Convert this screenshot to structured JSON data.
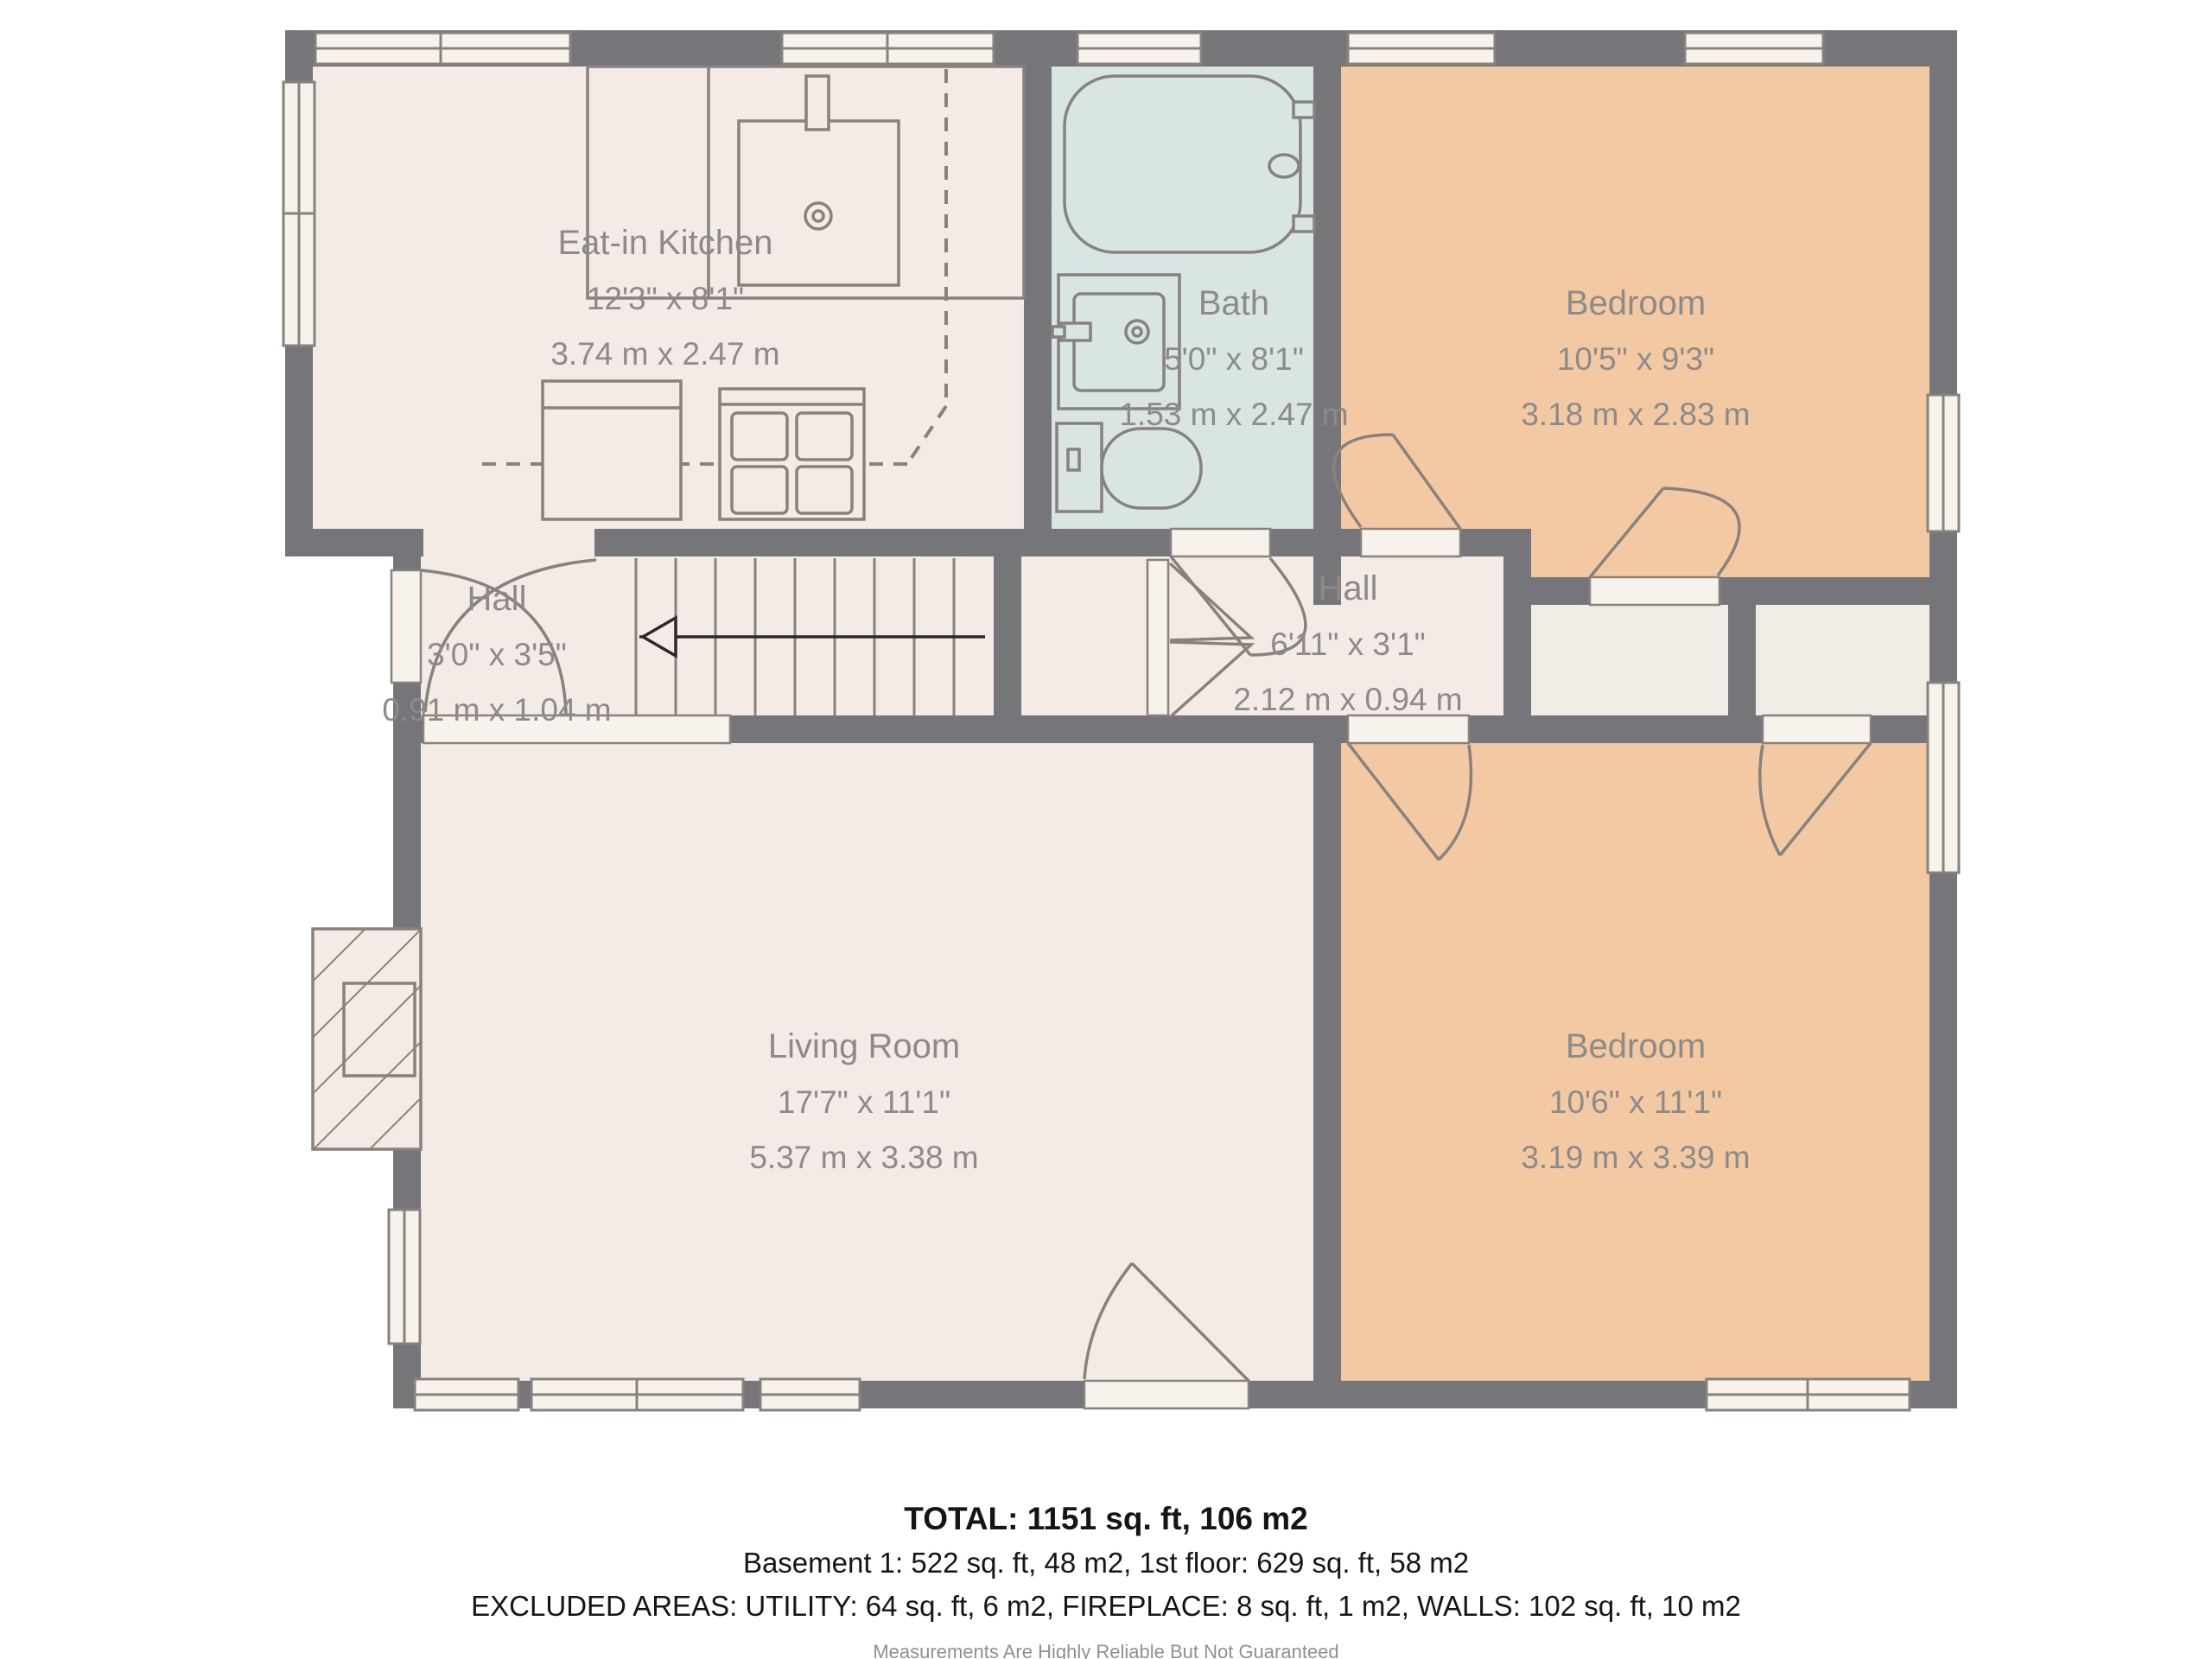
{
  "plan_title": "1st floor plan",
  "rooms": [
    {
      "id": "eat-in-kitchen",
      "name": "Eat-in Kitchen",
      "imperial": "12'3\" x 8'1\"",
      "metric": "3.74 m x 2.47 m"
    },
    {
      "id": "bath",
      "name": "Bath",
      "imperial": "5'0\" x 8'1\"",
      "metric": "1.53 m x 2.47 m"
    },
    {
      "id": "bedroom-top",
      "name": "Bedroom",
      "imperial": "10'5\" x 9'3\"",
      "metric": "3.18 m x 2.83 m"
    },
    {
      "id": "hall-left",
      "name": "Hall",
      "imperial": "3'0\" x 3'5\"",
      "metric": "0.91 m x 1.04 m"
    },
    {
      "id": "hall-center",
      "name": "Hall",
      "imperial": "6'11\" x 3'1\"",
      "metric": "2.12 m x 0.94 m"
    },
    {
      "id": "living-room",
      "name": "Living Room",
      "imperial": "17'7\" x 11'1\"",
      "metric": "5.37 m x 3.38 m"
    },
    {
      "id": "bedroom-bottom",
      "name": "Bedroom",
      "imperial": "10'6\" x 11'1\"",
      "metric": "3.19 m x 3.39 m"
    }
  ],
  "fixtures": [
    "bathtub",
    "bathroom-sink",
    "toilet",
    "kitchen-sink",
    "kitchen-counter",
    "fridge",
    "stove",
    "stairs",
    "fireplace"
  ],
  "summary": {
    "total": "TOTAL: 1151 sq. ft, 106 m2",
    "floors": "Basement 1: 522 sq. ft, 48 m2, 1st floor: 629 sq. ft, 58 m2",
    "excluded": "EXCLUDED AREAS: UTILITY: 64 sq. ft, 6 m2, FIREPLACE: 8 sq. ft, 1 m2, WALLS: 102 sq. ft, 10 m2",
    "disclaimer": "Measurements Are Highly Reliable But Not Guaranteed"
  },
  "colors": {
    "wall": "#76767a",
    "floor": "#f4ebe6",
    "bath_floor": "#d8e5e2",
    "bedroom_floor": "#f2c9a3",
    "fixture_line": "#87827b",
    "label_text": "#8c8b89",
    "opening": "#f8f2ed"
  }
}
